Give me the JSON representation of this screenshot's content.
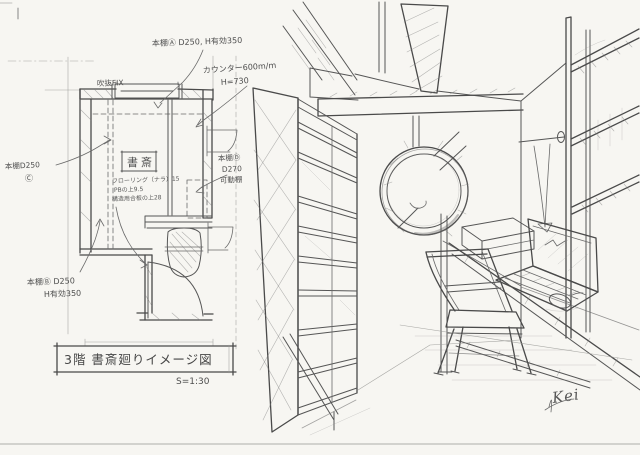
{
  "colors": {
    "paper": "#f7f6f2",
    "pencil": "#4a4a4a",
    "pencil_light": "#9a9a97",
    "scan_edge_strip": "#4b4b49"
  },
  "plan": {
    "room_label": "書斎",
    "window_label": "吹抜FIX",
    "shelf_a_label": "本棚Ⓐ D250, H有効350",
    "counter_label_line1": "カウンター600m/m",
    "counter_label_line2": "H=730",
    "shelf_c_label_line1": "本棚D250",
    "shelf_c_label_line2": "Ⓒ",
    "shelf_d_label_line1": "本棚Ⓓ",
    "shelf_d_label_line2": "D270",
    "shelf_d_label_line3": "可動棚",
    "shelf_b_label_line1": "本棚Ⓑ D250",
    "shelf_b_label_line2": "H有効350",
    "floor_note_line1": "フローリング（ナラ）15",
    "floor_note_line2": "PBの上9.5",
    "floor_note_line3": "構造用合板の上28"
  },
  "title_block": {
    "title": "3階 書斎廻りイメージ図",
    "scale": "S=1:30"
  },
  "signature": "Kei"
}
